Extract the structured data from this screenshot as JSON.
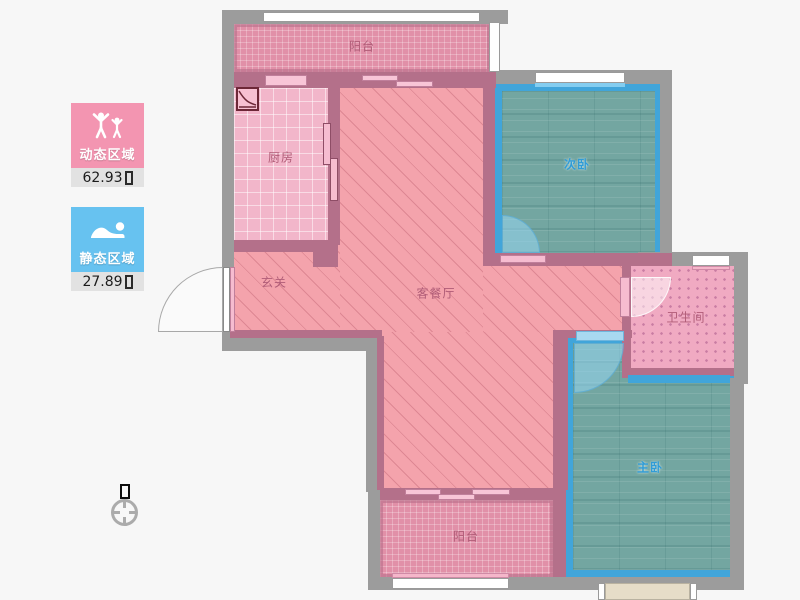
{
  "page": {
    "background": "#f7f7f7"
  },
  "legend": [
    {
      "id": "dynamic",
      "label": "动态区域",
      "value": "62.93",
      "unit_glyph": "□",
      "color": "#f395b1",
      "icon": "people-active-icon"
    },
    {
      "id": "static",
      "label": "静态区域",
      "value": "27.89",
      "unit_glyph": "□",
      "color": "#67c2f0",
      "icon": "person-resting-icon"
    }
  ],
  "compass": {
    "north_glyph": "□"
  },
  "floorplan": {
    "rooms": [
      {
        "id": "balcony-top",
        "label": "阳台"
      },
      {
        "id": "kitchen",
        "label": "厨房"
      },
      {
        "id": "foyer",
        "label": "玄关"
      },
      {
        "id": "living-dining",
        "label": "客餐厅"
      },
      {
        "id": "bedroom-second",
        "label": "次卧",
        "highlighted": true
      },
      {
        "id": "bathroom",
        "label": "卫生间"
      },
      {
        "id": "bedroom-master",
        "label": "主卧",
        "highlighted": true
      },
      {
        "id": "balcony-bottom",
        "label": "阳台"
      }
    ],
    "colors": {
      "wall_outer": "#9c9c9c",
      "wall_inner": "#b4708a",
      "room_pink": "#f4a3ac",
      "room_highlight_border": "#41a5da",
      "bedroom_floor": "#73a6a1",
      "window": "#ffffff"
    }
  }
}
